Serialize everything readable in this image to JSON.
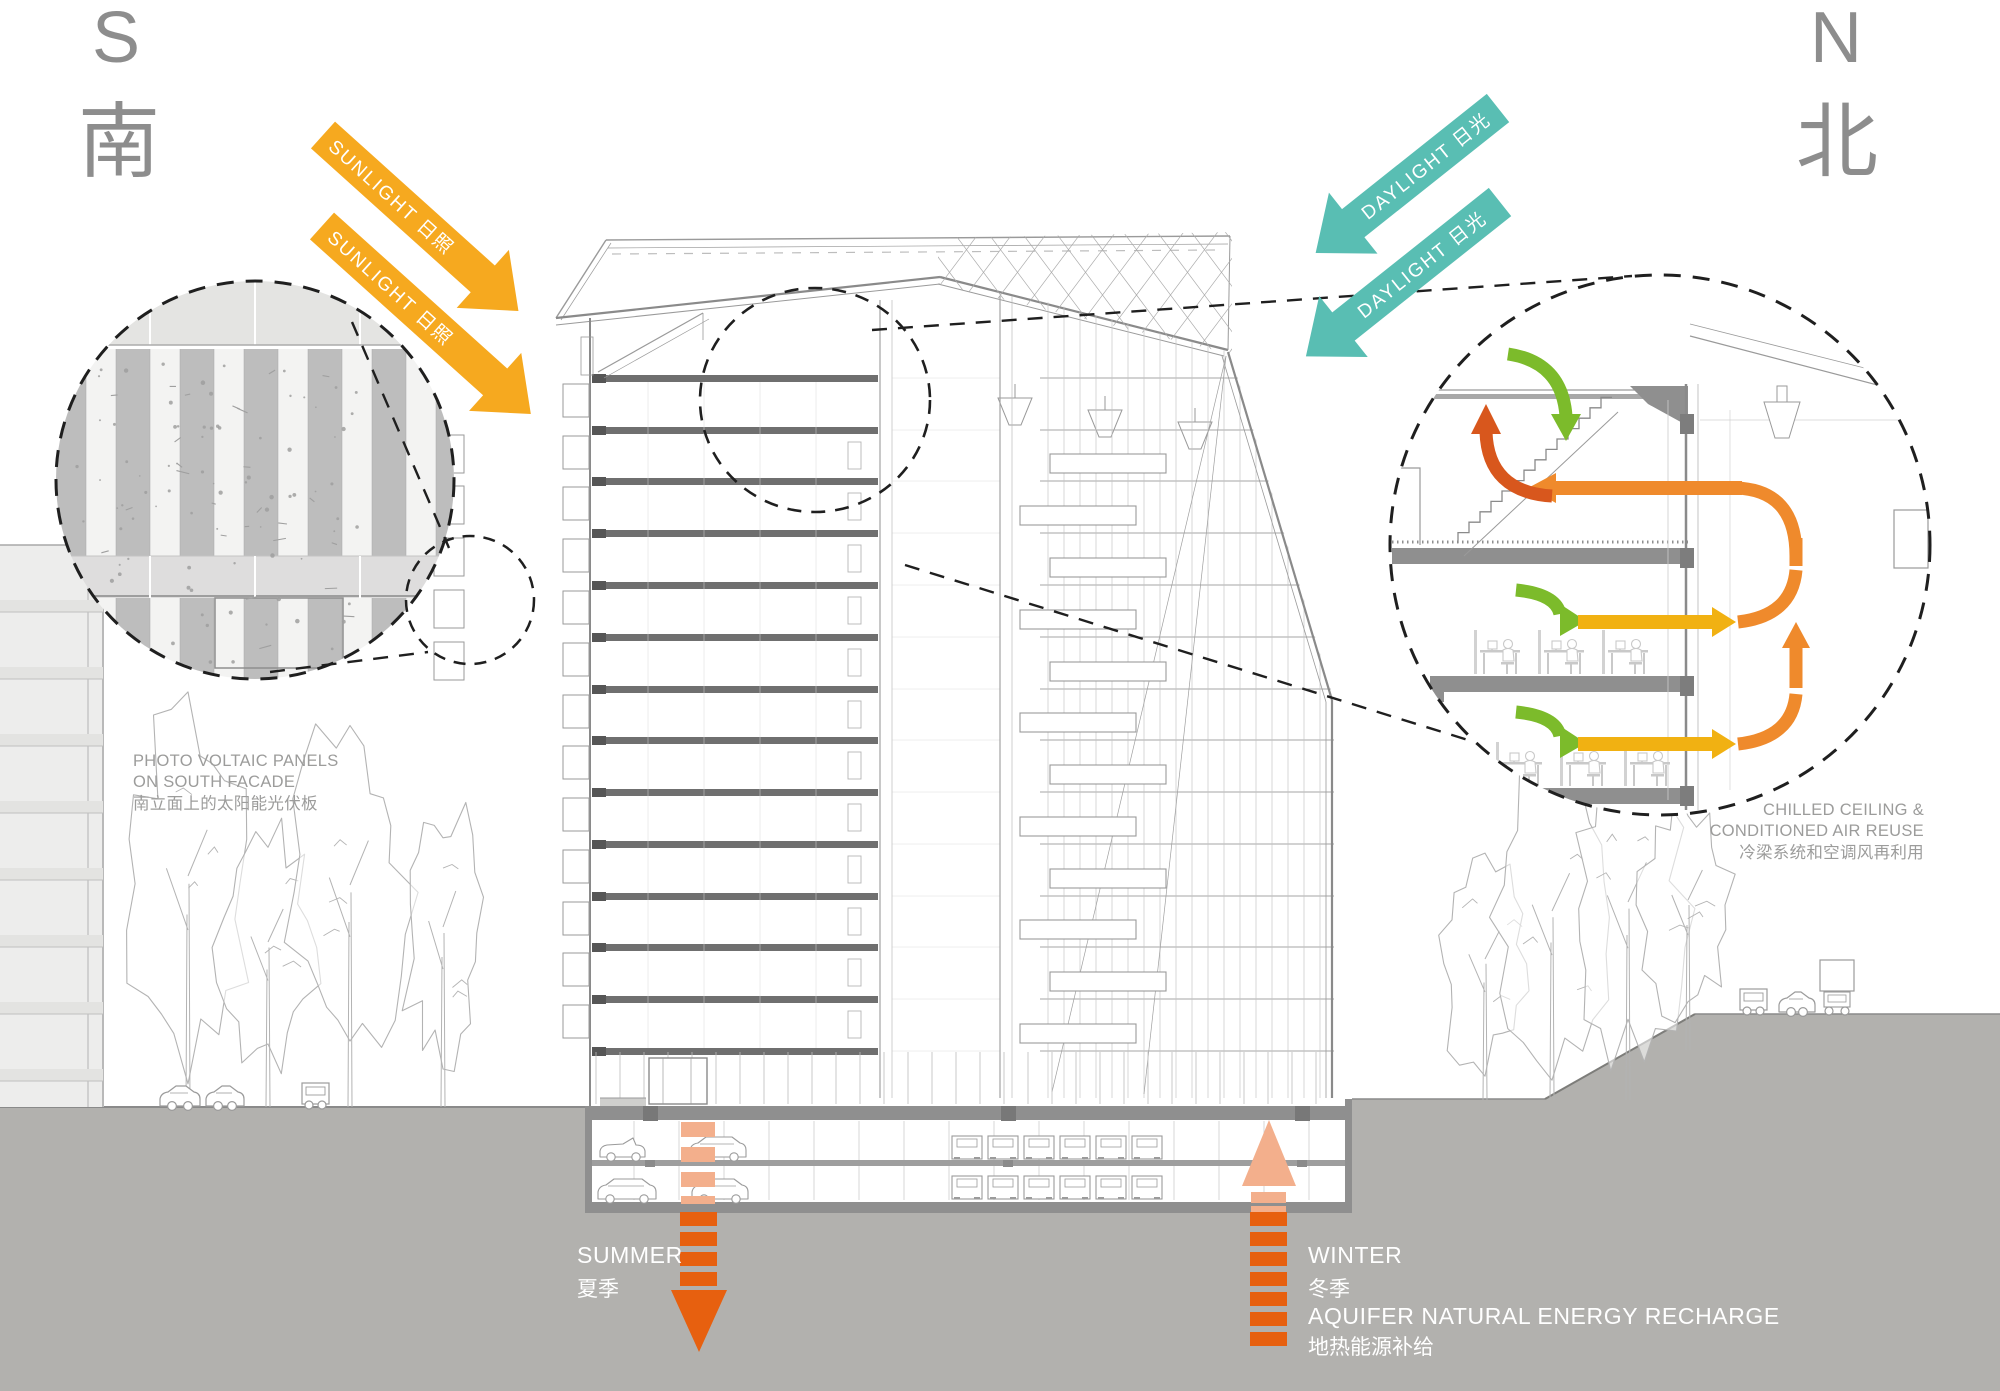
{
  "compass": {
    "south_letter": "S",
    "south_cn": "南",
    "north_letter": "N",
    "north_cn": "北"
  },
  "flows": {
    "sunlight_label": "SUNLIGHT 日照",
    "daylight_label": "DAYLIGHT 日光"
  },
  "callouts": {
    "pv_line1": "PHOTO VOLTAIC PANELS",
    "pv_line2": "ON SOUTH FACADE",
    "pv_line3": "南立面上的太阳能光伏板",
    "chilled_line1": "CHILLED CEILING &",
    "chilled_line2": "CONDITIONED AIR REUSE",
    "chilled_line3": "冷梁系统和空调风再利用"
  },
  "geothermal": {
    "summer": "SUMMER",
    "summer_cn": "夏季",
    "winter": "WINTER",
    "winter_cn": "冬季",
    "aquifer": "AQUIFER NATURAL ENERGY RECHARGE",
    "aquifer_cn": "地热能源补给"
  },
  "colors": {
    "sunlight": "#F6A91F",
    "daylight": "#59BEB3",
    "energy_orange": "#E7600F",
    "energy_orange_light": "#F3AF8C",
    "flow_green": "#7CBB2B",
    "flow_yellow": "#F1B112",
    "flow_orange": "#EF8A2C",
    "flow_red": "#D8571D",
    "ground_gray": "#B2B1AE",
    "label_gray": "#9C9C9B",
    "compass_gray": "#8D8D8D",
    "line_light": "#BDBDBD",
    "line_mid": "#9A9A9A",
    "line_dark": "#8A8A8A",
    "slab_dark": "#6F6F6F",
    "outline": "#B3B3B3",
    "carline": "#9B9B9B",
    "dash_black": "#1F1F1F"
  }
}
